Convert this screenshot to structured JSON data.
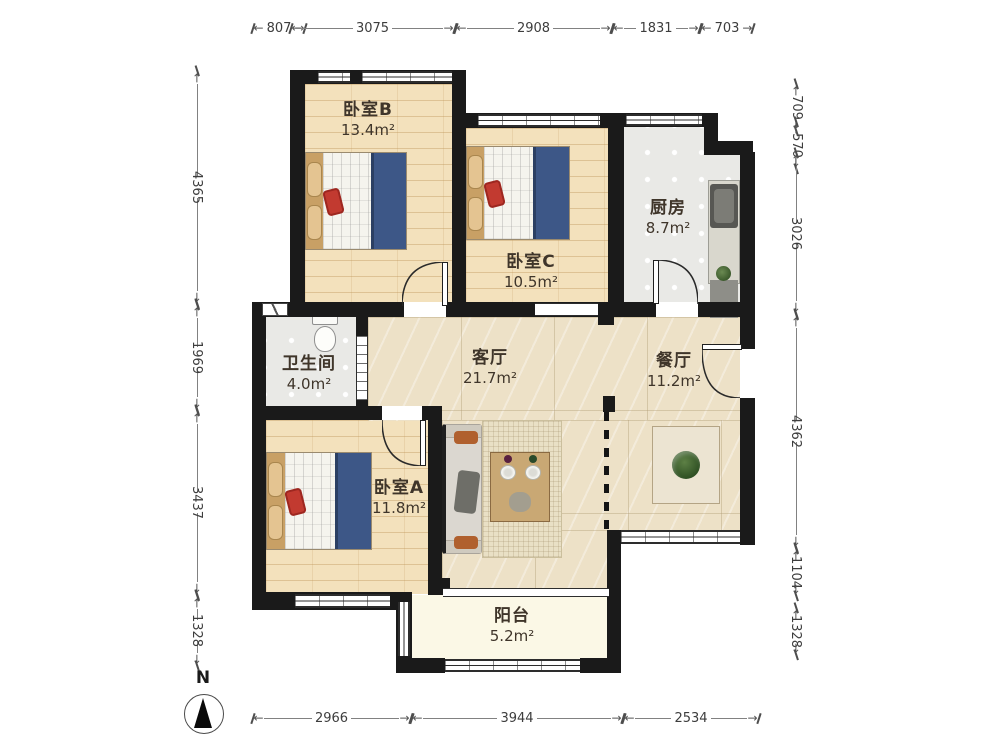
{
  "title": "apartment-floor-plan",
  "compass": {
    "north_label": "N"
  },
  "rooms": [
    {
      "id": "bedroom-b",
      "name": "卧室B",
      "area": "13.4m²"
    },
    {
      "id": "bedroom-c",
      "name": "卧室C",
      "area": "10.5m²"
    },
    {
      "id": "kitchen",
      "name": "厨房",
      "area": "8.7m²"
    },
    {
      "id": "bathroom",
      "name": "卫生间",
      "area": "4.0m²"
    },
    {
      "id": "living-room",
      "name": "客厅",
      "area": "21.7m²"
    },
    {
      "id": "dining-room",
      "name": "餐厅",
      "area": "11.2m²"
    },
    {
      "id": "bedroom-a",
      "name": "卧室A",
      "area": "11.8m²"
    },
    {
      "id": "balcony",
      "name": "阳台",
      "area": "5.2m²"
    }
  ],
  "dimensions": {
    "top": [
      "807",
      "3075",
      "2908",
      "1831",
      "703"
    ],
    "left": [
      "4365",
      "1969",
      "3437",
      "1328"
    ],
    "right": [
      "709",
      "570",
      "3026",
      "4362",
      "1104",
      "1328"
    ],
    "bottom": [
      "2966",
      "3944",
      "2534"
    ]
  },
  "colors": {
    "wall": "#1a1a1a",
    "wood_floor": "#f3e1bc",
    "tile_floor": "#e9e9e6",
    "marble_floor": "#ede1c7",
    "balcony_floor": "#fbf8e6",
    "blanket_blue": "#3d5787",
    "pillow_tan": "#e4c491",
    "sofa_pillow_orange": "#b0602e",
    "chair_back_red": "#a2503a",
    "dimension_text": "#3d3d3d"
  }
}
